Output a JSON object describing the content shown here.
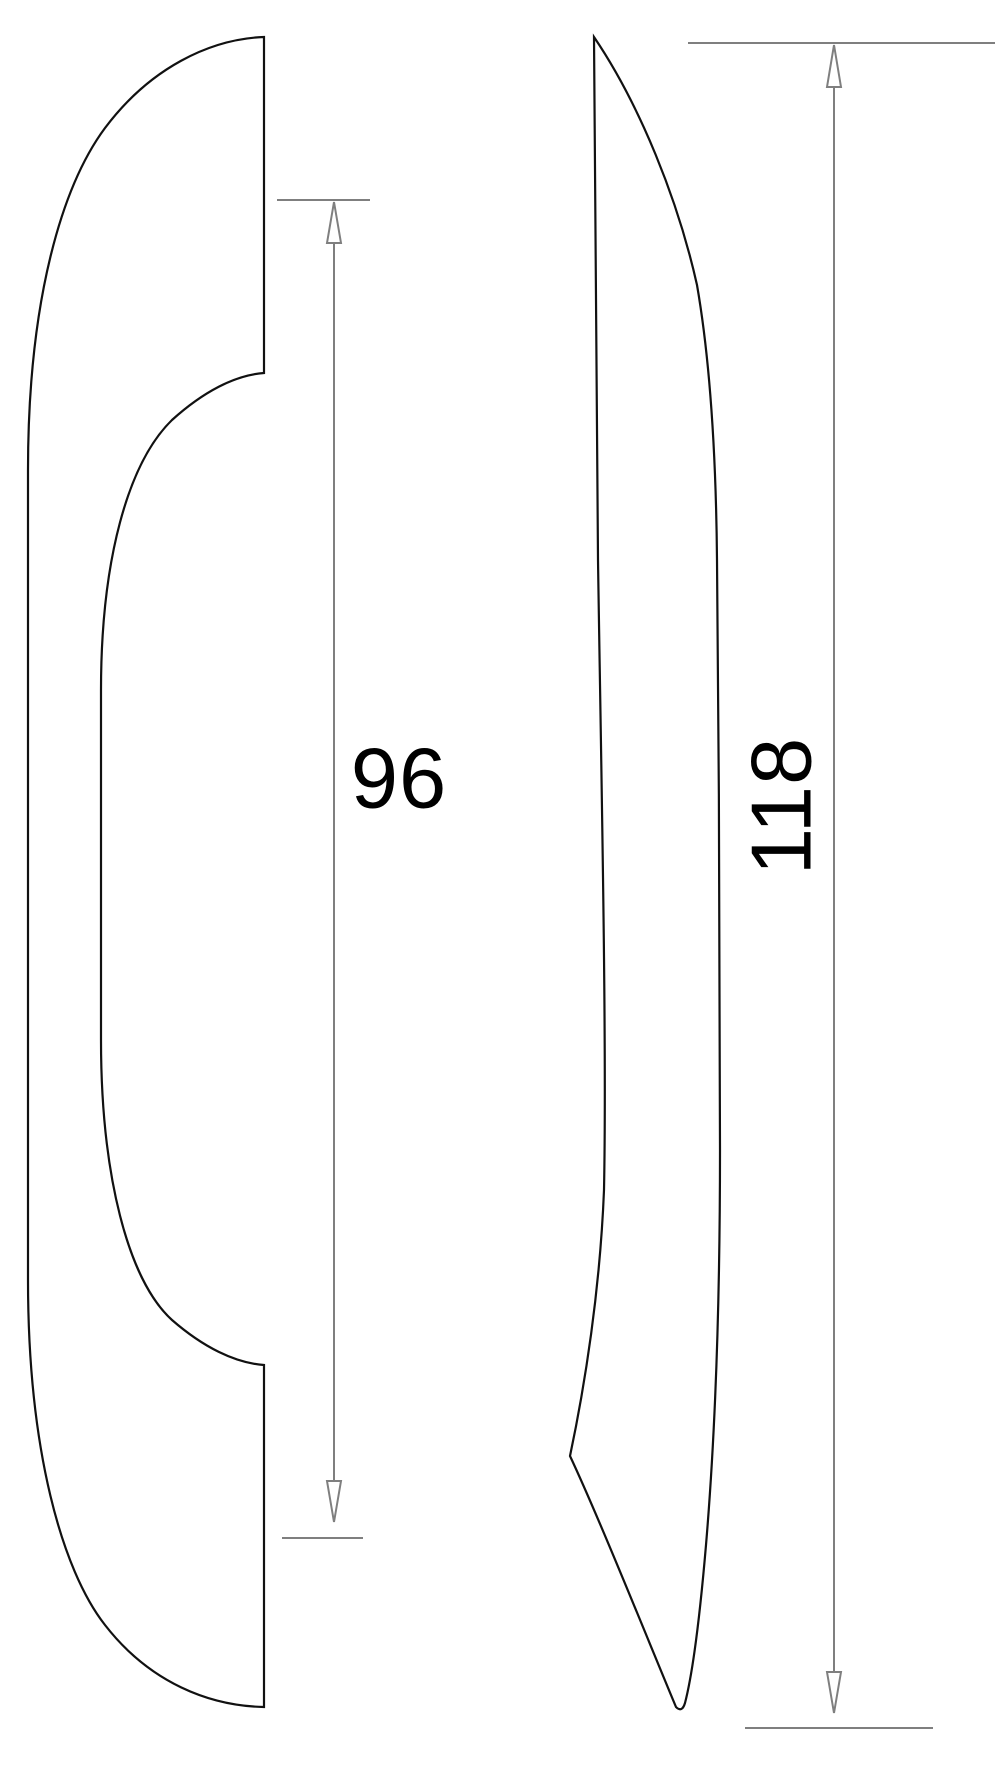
{
  "drawing": {
    "kind": "technical-drawing",
    "views": {
      "front": {
        "name": "handle front profile"
      },
      "side": {
        "name": "handle side profile"
      }
    },
    "dimensions": [
      {
        "value": "96",
        "orientation": "vertical"
      },
      {
        "value": "118",
        "orientation": "vertical-rotated"
      }
    ],
    "colors": {
      "background": "#ffffff",
      "outline": "#111111",
      "dimension": "#7f7f7f",
      "text": "#000000"
    }
  }
}
